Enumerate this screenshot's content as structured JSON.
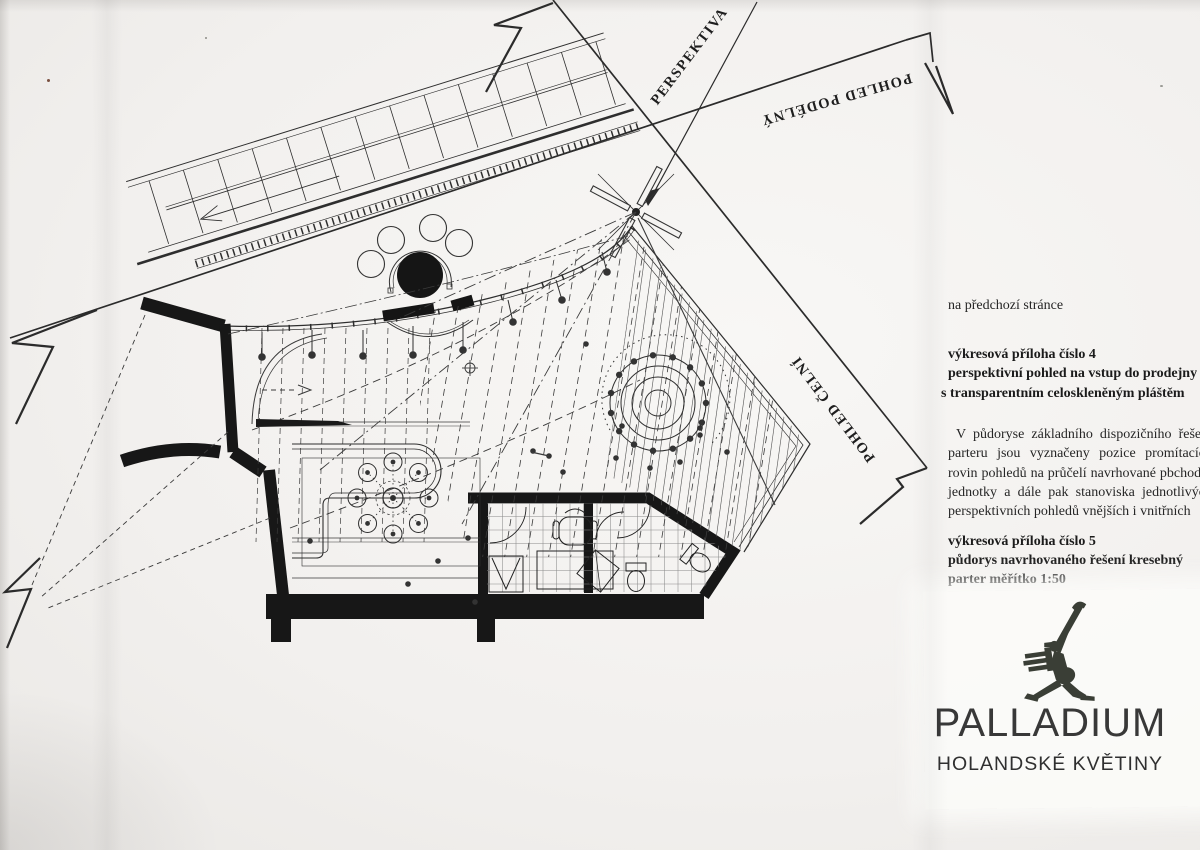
{
  "page": {
    "paper_color": "#f1efeb",
    "ink_color": "#2e2e2e",
    "wall_color": "#171717"
  },
  "drawing": {
    "labels": {
      "perspektiva": "PERSPEKTIVA",
      "pohled_podelny": "POHLED PODÉLNÝ",
      "pohled_celni": "POHLED ČELNÍ"
    }
  },
  "notes": {
    "intro": "na předchozí stránce",
    "attachment4": {
      "title": "výkresová příloha číslo 4",
      "line1": "perspektivní pohled na vstup do prodejny",
      "line2": "s transparentním celoskleněným pláštěm"
    },
    "body": "V půdoryse základního dispozičního řešení parteru jsou vyznačeny pozice promítacích rovin pohledů na průčelí navrhované pbchodní jednotky a dále pak stanoviska jednotlivých perspektivních pohledů vnějších i vnitřních",
    "attachment5": {
      "title": "výkresová příloha číslo 5",
      "line1": "půdorys navrhovaného řešení kresebný",
      "line2": "parter měřítko 1:50"
    }
  },
  "logo": {
    "brand": "PALLADIUM",
    "subtitle": "HOLANDSKÉ KVĚTINY",
    "color": "#3a3e36"
  }
}
